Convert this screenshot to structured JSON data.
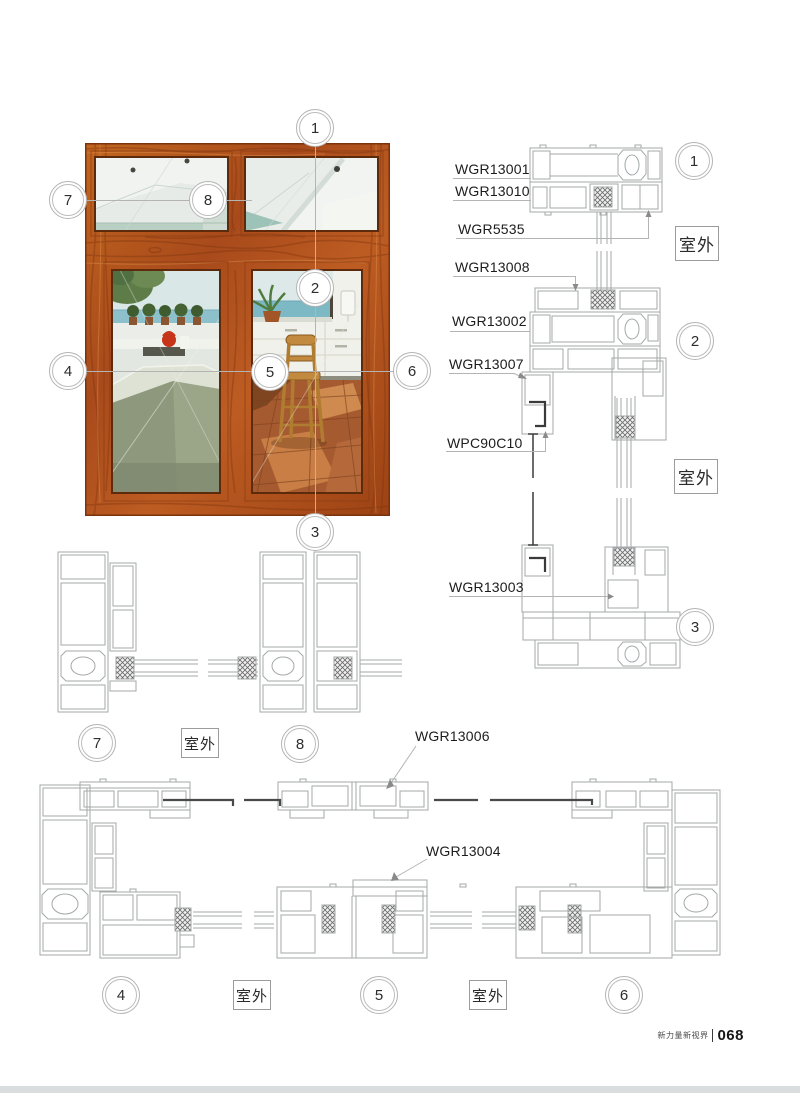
{
  "page": {
    "footer": {
      "brand": "新力量新视界",
      "page_number": "068"
    }
  },
  "labels": {
    "outdoor": "室外"
  },
  "callouts": [
    "1",
    "2",
    "3",
    "4",
    "5",
    "6",
    "7",
    "8"
  ],
  "part_labels": [
    {
      "text": "WGR13001"
    },
    {
      "text": "WGR13010"
    },
    {
      "text": "WGR5535"
    },
    {
      "text": "WGR13008"
    },
    {
      "text": "WGR13002"
    },
    {
      "text": "WGR13007"
    },
    {
      "text": "WPC90C10"
    },
    {
      "text": "WGR13003"
    },
    {
      "text": "WGR13006"
    },
    {
      "text": "WGR13004"
    }
  ],
  "colors": {
    "wood_frame": "#b0521c",
    "drawing_line": "#a4a8aa",
    "seal_dark": "#3a3a3a",
    "page_edge": "#d9dddd"
  }
}
